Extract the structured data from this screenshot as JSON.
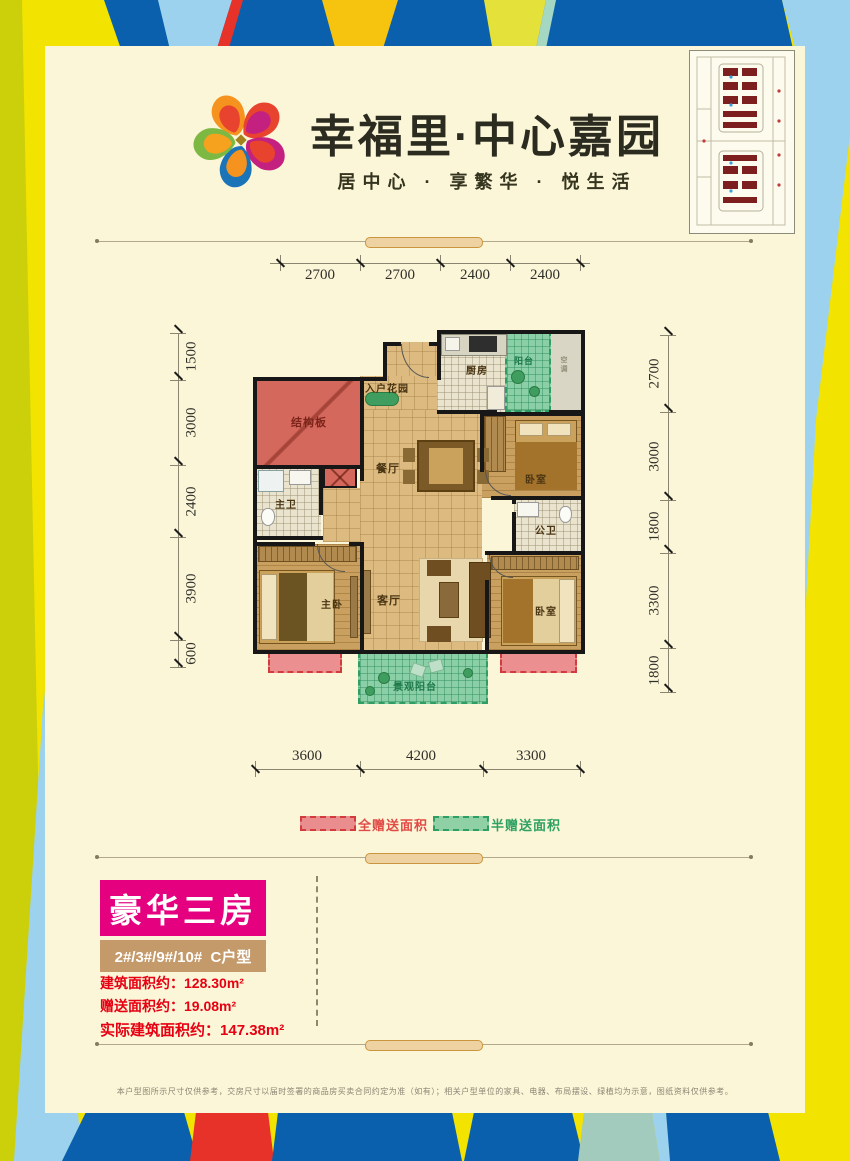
{
  "header": {
    "title": "幸福里·中心嘉园",
    "subtitle": "居中心 · 享繁华 · 悦生活"
  },
  "floor_plan": {
    "dims_top": [
      "2700",
      "2700",
      "2400",
      "2400"
    ],
    "dims_bottom": [
      "3600",
      "4200",
      "3300"
    ],
    "dims_left": [
      "1500",
      "3000",
      "2400",
      "3900",
      "600"
    ],
    "dims_right": [
      "2700",
      "3000",
      "1800",
      "3300",
      "1800"
    ],
    "rooms": {
      "structure_panel": "结构板",
      "entry_garden": "入户花园",
      "kitchen": "厨房",
      "balcony_top": "阳台",
      "ac_area": "空调",
      "bedroom_top": "卧室",
      "dining": "餐厅",
      "master_bath": "主卫",
      "master_bedroom": "主卧",
      "living": "客厅",
      "public_bath": "公卫",
      "bedroom_bottom": "卧室",
      "view_balcony": "景观阳台"
    }
  },
  "legend": {
    "full_gift": "全赠送面积",
    "half_gift": "半赠送面积",
    "full_color": "#ea8d8e",
    "half_color": "#8fd0a5"
  },
  "unit_info": {
    "type_badge": "豪华三房",
    "buildings": "2#/3#/9#/10#  C户型",
    "areas": [
      {
        "label": "建筑面积约：",
        "value": "128.30m²"
      },
      {
        "label": "赠送面积约：",
        "value": "19.08m²"
      },
      {
        "label": "实际建筑面积约：",
        "value": "147.38m²"
      }
    ]
  },
  "colors": {
    "accent_magenta": "#e4007f",
    "area_text_red": "#e60012",
    "border_blue": "#0a60ac",
    "border_yellow": "#f2e300",
    "border_sky": "#9cd2ee"
  },
  "footer": {
    "disclaimer": "本户型图所示尺寸仅供参考，交房尺寸以届时签署的商品房买卖合同约定为准（如有）；相关户型单位的家具、电器、布局摆设、绿植均为示意，图纸资料仅供参考。"
  }
}
